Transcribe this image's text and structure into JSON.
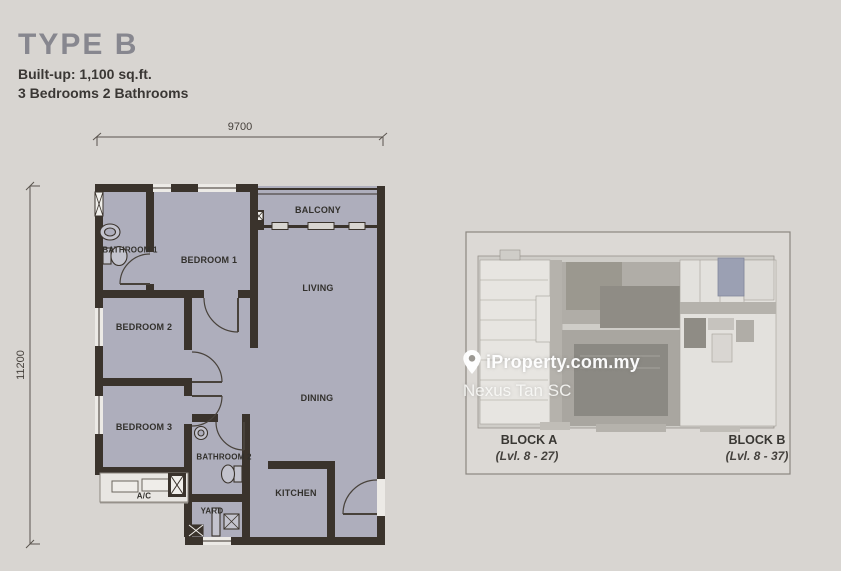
{
  "header": {
    "title": "TYPE B",
    "built_up": "Built-up: 1,100 sq.ft.",
    "bedrooms": "3 Bedrooms 2 Bathrooms"
  },
  "floor_plan": {
    "dim_width": "9700",
    "dim_height": "11200",
    "rooms": [
      {
        "id": "balcony",
        "label": "BALCONY"
      },
      {
        "id": "living",
        "label": "LIVING"
      },
      {
        "id": "bedroom1",
        "label": "BEDROOM 1"
      },
      {
        "id": "bathroom1",
        "label": "BATHROOM 1"
      },
      {
        "id": "bedroom2",
        "label": "BEDROOM 2"
      },
      {
        "id": "bedroom3",
        "label": "BEDROOM 3"
      },
      {
        "id": "dining",
        "label": "DINING"
      },
      {
        "id": "bathroom2",
        "label": "BATHROOM 2"
      },
      {
        "id": "kitchen",
        "label": "KITCHEN"
      },
      {
        "id": "yard",
        "label": "YARD"
      },
      {
        "id": "ac",
        "label": "A/C"
      }
    ],
    "colors": {
      "wall": "#3a332c",
      "room_fill": "#aeaebc",
      "paper": "#d8d5d1"
    }
  },
  "key_plan": {
    "watermark": {
      "brand": "iProperty.com.my",
      "agent": "Nexus Tan SC"
    },
    "blocks": [
      {
        "name": "BLOCK A",
        "levels": "(Lvl. 8 - 27)"
      },
      {
        "name": "BLOCK B",
        "levels": "(Lvl. 8 - 37)"
      }
    ],
    "highlight_color": "#9ba0b3"
  }
}
